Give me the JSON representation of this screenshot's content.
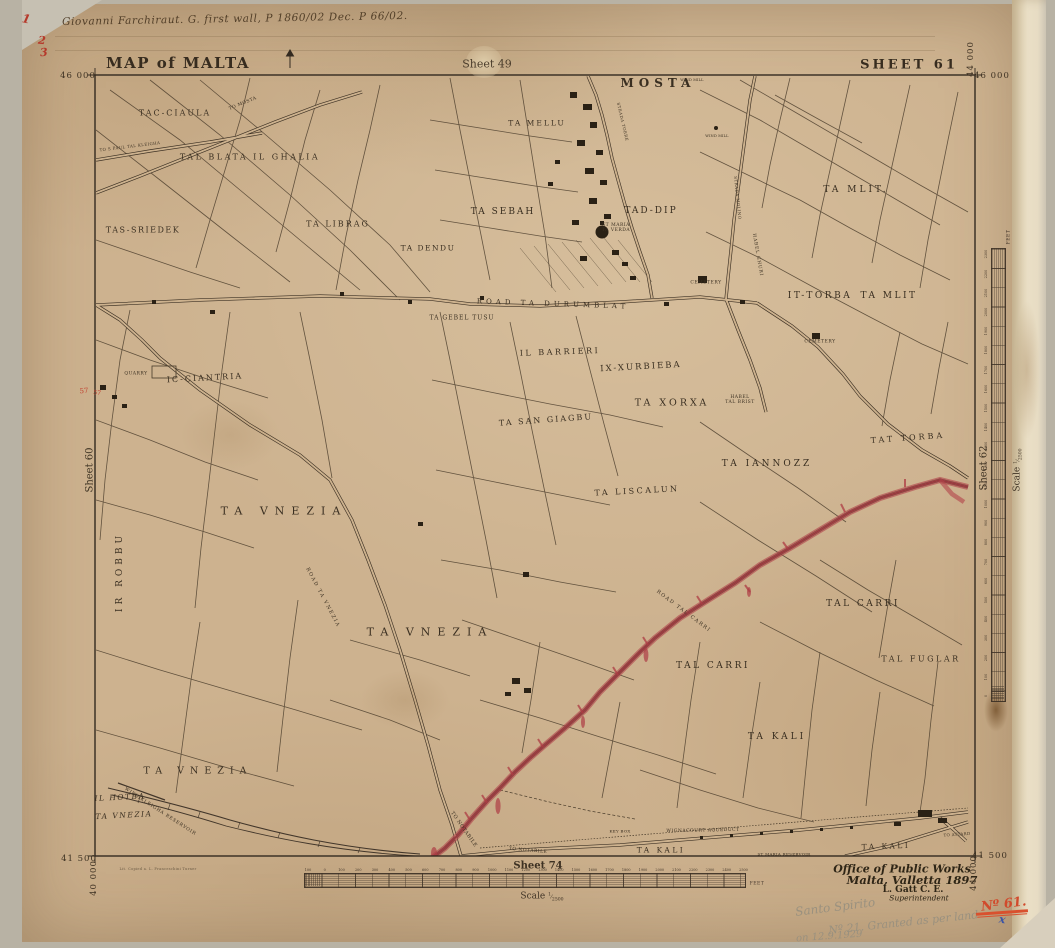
{
  "document": {
    "title": "MAP of MALTA",
    "sheet": "SHEET 61",
    "adjacent_sheets": {
      "top": "Sheet 49",
      "left": "Sheet 60",
      "right": "Sheet 62",
      "bottom": "Sheet 74"
    },
    "grid_coordinates": {
      "top_left": "46 000",
      "top_right": "46 000",
      "top_right_vertical": "44 000",
      "bottom_left": "41 500",
      "bottom_left_vertical": "40 000",
      "bottom_right": "41 500",
      "bottom_right_vertical": "44 000"
    },
    "imprint": {
      "line1": "Office of Public Works",
      "line2": "Malta, Valletta 1897",
      "line3": "L. Gatt C. E.",
      "line4": "Superintendent"
    },
    "annotations": {
      "ink_note": "Giovanni Farchiraut. G. first wall, P 1860/02 Dec. P 66/02.",
      "margin_marks": [
        "1",
        "2",
        "3"
      ],
      "pencil_note_1": "Santo Spirito",
      "pencil_note_2": "Nº 21. Granted as per land",
      "pencil_note_3": "on 12.9.1929",
      "red_number": "Nº 61.",
      "blue_mark": "x"
    },
    "scale_bottom": {
      "label": "Scale",
      "ratio_num": "1",
      "ratio_den": "2500",
      "unit": "FEET",
      "ticks": [
        "100",
        "0",
        "100",
        "200",
        "300",
        "400",
        "500",
        "600",
        "700",
        "800",
        "900",
        "1000",
        "1100",
        "1200",
        "1300",
        "1400",
        "1500",
        "1600",
        "1700",
        "1800",
        "1900",
        "2000",
        "2100",
        "2200",
        "2300",
        "2400",
        "2500"
      ]
    },
    "scale_right": {
      "label": "Scale",
      "ratio_num": "1",
      "ratio_den": "2500",
      "unit": "FEET",
      "ticks": [
        "0",
        "100",
        "200",
        "300",
        "400",
        "500",
        "600",
        "700",
        "800",
        "900",
        "1000",
        "1100",
        "1200",
        "1300",
        "1400",
        "1500",
        "1600",
        "1700",
        "1800",
        "1900",
        "2000",
        "2100",
        "2200",
        "2300"
      ]
    }
  },
  "map_labels": [
    {
      "t": "TAC-CIAULA",
      "x": 175,
      "y": 113,
      "fs": 8,
      "ls": 2
    },
    {
      "t": "TAL BLATA IL GHALIA",
      "x": 250,
      "y": 157,
      "fs": 8,
      "ls": 2.5
    },
    {
      "t": "TA MELLU",
      "x": 537,
      "y": 124,
      "fs": 7.5,
      "ls": 2
    },
    {
      "t": "MOSTA",
      "x": 658,
      "y": 84,
      "fs": 12,
      "ls": 5,
      "b": 1
    },
    {
      "t": "TA SEBAH",
      "x": 503,
      "y": 212,
      "fs": 9,
      "ls": 2
    },
    {
      "t": "TAD-DIP",
      "x": 651,
      "y": 211,
      "fs": 9,
      "ls": 2
    },
    {
      "t": "TAS-SRIEDEK",
      "x": 143,
      "y": 230,
      "fs": 8,
      "ls": 1.5
    },
    {
      "t": "TA LIBRAG",
      "x": 338,
      "y": 224,
      "fs": 8,
      "ls": 2
    },
    {
      "t": "TA DENDU",
      "x": 428,
      "y": 249,
      "fs": 7.5,
      "ls": 1.5
    },
    {
      "t": "ST MARIA\nTA VERDA",
      "x": 616,
      "y": 228,
      "fs": 4.5,
      "ls": 0.5
    },
    {
      "t": "TA MLIT.",
      "x": 856,
      "y": 190,
      "fs": 9,
      "ls": 3
    },
    {
      "t": "IT-TORBA",
      "x": 820,
      "y": 296,
      "fs": 9,
      "ls": 2.5
    },
    {
      "t": "TA MLIT",
      "x": 889,
      "y": 296,
      "fs": 9,
      "ls": 2.5
    },
    {
      "t": "CEMETERY",
      "x": 706,
      "y": 283,
      "fs": 4.5,
      "ls": 0.5
    },
    {
      "t": "CEMETERY",
      "x": 820,
      "y": 342,
      "fs": 4.5,
      "ls": 0.5
    },
    {
      "t": "ROAD TA DURUMBLAT",
      "x": 553,
      "y": 304,
      "fs": 7,
      "ls": 4,
      "rot": 2
    },
    {
      "t": "TA GEBEL TUSU",
      "x": 462,
      "y": 319,
      "fs": 6,
      "ls": 1
    },
    {
      "t": "IL BARRIERI",
      "x": 560,
      "y": 352,
      "fs": 8,
      "ls": 2.5,
      "rot": -2
    },
    {
      "t": "IX-XURBIEBA",
      "x": 641,
      "y": 368,
      "fs": 8.5,
      "ls": 2,
      "rot": -3
    },
    {
      "t": "IC-CIANTRIA",
      "x": 205,
      "y": 378,
      "fs": 8,
      "ls": 2,
      "rot": -3
    },
    {
      "t": "QUARRY",
      "x": 136,
      "y": 374,
      "fs": 4.5,
      "ls": 0.5
    },
    {
      "t": "TA XORXA",
      "x": 672,
      "y": 404,
      "fs": 9.5,
      "ls": 3
    },
    {
      "t": "HABEL\nTAL BRIST",
      "x": 740,
      "y": 400,
      "fs": 4.5,
      "ls": 0.5
    },
    {
      "t": "TA SAN GIAGBU",
      "x": 546,
      "y": 420,
      "fs": 8,
      "ls": 2,
      "rot": -4
    },
    {
      "t": "TA IANNOZZ",
      "x": 767,
      "y": 464,
      "fs": 9,
      "ls": 3
    },
    {
      "t": "TAT TORBA",
      "x": 908,
      "y": 438,
      "fs": 8,
      "ls": 3,
      "rot": -4
    },
    {
      "t": "TA LISCALUN",
      "x": 637,
      "y": 491,
      "fs": 8,
      "ls": 2.5,
      "rot": -3
    },
    {
      "t": "TA VNEZIA",
      "x": 284,
      "y": 512,
      "fs": 11,
      "ls": 7
    },
    {
      "t": "IR ROBBU",
      "x": 120,
      "y": 572,
      "fs": 9,
      "ls": 4,
      "rot": -90
    },
    {
      "t": "ROAD TA VNEZIA",
      "x": 322,
      "y": 598,
      "fs": 5,
      "ls": 1.5,
      "rot": 62
    },
    {
      "t": "TA VNEZIA",
      "x": 430,
      "y": 633,
      "fs": 11,
      "ls": 7
    },
    {
      "t": "TAL CARRI",
      "x": 863,
      "y": 604,
      "fs": 9,
      "ls": 2.5
    },
    {
      "t": "TAL FUGLAR",
      "x": 921,
      "y": 659,
      "fs": 8,
      "ls": 2.5
    },
    {
      "t": "TAL CARRI",
      "x": 713,
      "y": 666,
      "fs": 9,
      "ls": 2.5
    },
    {
      "t": "ROAD TAL CARRI",
      "x": 683,
      "y": 612,
      "fs": 5,
      "ls": 1.5,
      "rot": 37
    },
    {
      "t": "TA KALI",
      "x": 777,
      "y": 737,
      "fs": 9,
      "ls": 3
    },
    {
      "t": "TA VNEZIA",
      "x": 198,
      "y": 772,
      "fs": 9.5,
      "ls": 6
    },
    {
      "t": "IL HOTBA",
      "x": 120,
      "y": 798,
      "fs": 7.5,
      "ls": 1.5,
      "i": 1,
      "rot": -3
    },
    {
      "t": "TA VNEZIA",
      "x": 124,
      "y": 816,
      "fs": 7.5,
      "ls": 1.5,
      "i": 1,
      "rot": -3
    },
    {
      "t": "WIED KLEIGHA RESERVOIR",
      "x": 160,
      "y": 812,
      "fs": 4.5,
      "ls": 0.8,
      "rot": 33
    },
    {
      "t": "TO NOTABILE",
      "x": 463,
      "y": 830,
      "fs": 5,
      "ls": 0.5,
      "rot": 55
    },
    {
      "t": "TO NOTABILE",
      "x": 528,
      "y": 851,
      "fs": 4.5,
      "ls": 0.5,
      "rot": 5
    },
    {
      "t": "KEY BOX",
      "x": 620,
      "y": 832,
      "fs": 4,
      "ls": 0.3
    },
    {
      "t": "WIGNACOURT AQUEDUCT",
      "x": 703,
      "y": 831,
      "fs": 4.5,
      "ls": 0.5,
      "rot": -1
    },
    {
      "t": "ST MARIA RESERVOIR",
      "x": 784,
      "y": 855,
      "fs": 4,
      "ls": 0.3
    },
    {
      "t": "TA KALI",
      "x": 661,
      "y": 851,
      "fs": 7.5,
      "ls": 2.5
    },
    {
      "t": "TA KALI",
      "x": 886,
      "y": 847,
      "fs": 7.5,
      "ls": 2.5,
      "rot": -2
    },
    {
      "t": "TO ATTARD",
      "x": 957,
      "y": 835,
      "fs": 4,
      "ls": 0.3,
      "rot": -4
    },
    {
      "t": "TO MOSTA",
      "x": 243,
      "y": 104,
      "fs": 4.5,
      "ls": 0.5,
      "rot": -22
    },
    {
      "t": "TO S PAUL TAL KLEIGHA",
      "x": 130,
      "y": 147,
      "fs": 4,
      "ls": 0.4,
      "rot": -7
    },
    {
      "t": "STRADA TORRE",
      "x": 622,
      "y": 122,
      "fs": 4,
      "ls": 0.5,
      "rot": 77
    },
    {
      "t": "STRADA MOLINO",
      "x": 737,
      "y": 198,
      "fs": 4,
      "ls": 0.5,
      "rot": 84
    },
    {
      "t": "HABEL GHURI",
      "x": 757,
      "y": 255,
      "fs": 4.5,
      "ls": 0.8,
      "rot": 80
    },
    {
      "t": "WIND MILL",
      "x": 692,
      "y": 80,
      "fs": 3.5,
      "ls": 0.2
    },
    {
      "t": "WIND MILL",
      "x": 717,
      "y": 136,
      "fs": 3.5,
      "ls": 0.2
    },
    {
      "t": "57",
      "x": 84,
      "y": 391,
      "fs": 7,
      "c": "#c2402e",
      "rot": -5,
      "hand": 1
    },
    {
      "t": "57",
      "x": 97,
      "y": 394,
      "fs": 6,
      "c": "#c2402e",
      "rot": 8,
      "hand": 1
    },
    {
      "t": "Lit. Copied a. L. Franceschini Turner",
      "x": 158,
      "y": 869,
      "fs": 3.5,
      "ls": 0.3,
      "c": "#6a5a44"
    }
  ]
}
